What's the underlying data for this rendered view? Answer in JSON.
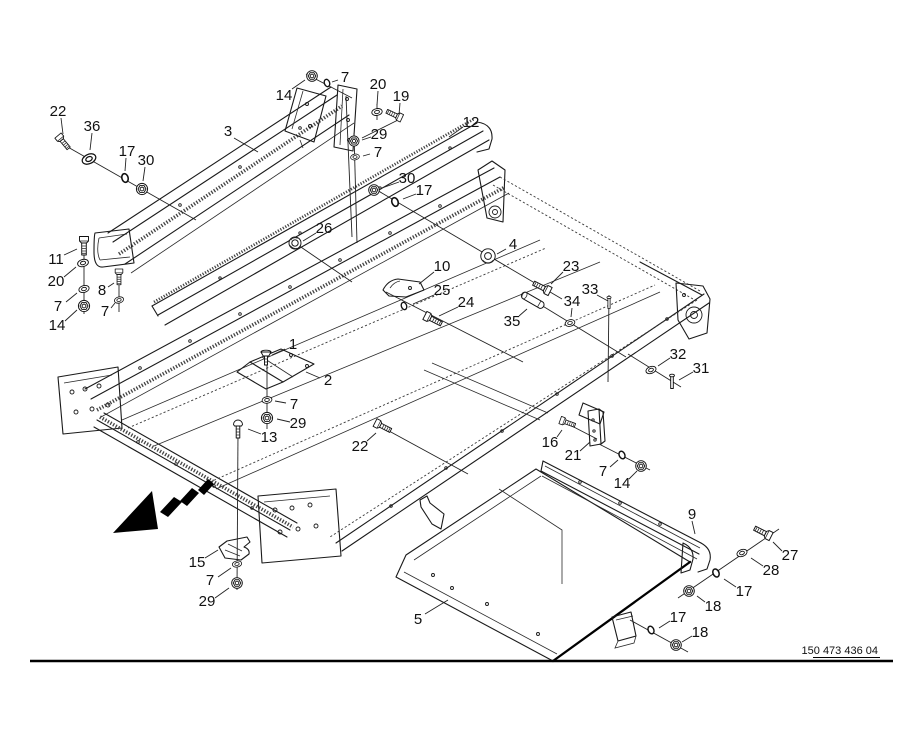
{
  "drawing": {
    "number": "150 473 436 04",
    "background": "#ffffff",
    "line_color": "#1a1a1a"
  },
  "arrow": {
    "meaning": "direction-of-travel",
    "color": "#000000"
  },
  "callouts": [
    {
      "t": "22",
      "x": 58,
      "y": 111,
      "l": [
        61,
        118,
        63,
        134
      ]
    },
    {
      "t": "36",
      "x": 92,
      "y": 126,
      "l": [
        92,
        133,
        90,
        150
      ]
    },
    {
      "t": "17",
      "x": 127,
      "y": 151,
      "l": [
        126,
        158,
        125,
        171
      ]
    },
    {
      "t": "30",
      "x": 146,
      "y": 160,
      "l": [
        145,
        167,
        143,
        181
      ]
    },
    {
      "t": "3",
      "x": 228,
      "y": 131,
      "l": [
        234,
        138,
        258,
        152
      ]
    },
    {
      "t": "14",
      "x": 284,
      "y": 95,
      "l": [
        292,
        89,
        305,
        80
      ]
    },
    {
      "t": "7",
      "x": 345,
      "y": 77,
      "l": [
        338,
        80,
        332,
        82
      ]
    },
    {
      "t": "20",
      "x": 378,
      "y": 84,
      "l": [
        378,
        91,
        377,
        105
      ]
    },
    {
      "t": "19",
      "x": 401,
      "y": 96,
      "l": [
        400,
        103,
        399,
        115
      ]
    },
    {
      "t": "29",
      "x": 379,
      "y": 134,
      "l": [
        371,
        137,
        362,
        140
      ]
    },
    {
      "t": "7",
      "x": 378,
      "y": 152,
      "l": [
        370,
        154,
        363,
        156
      ]
    },
    {
      "t": "12",
      "x": 471,
      "y": 122,
      "l": [
        463,
        127,
        449,
        137
      ]
    },
    {
      "t": "30",
      "x": 407,
      "y": 178,
      "l": [
        399,
        182,
        382,
        188
      ]
    },
    {
      "t": "17",
      "x": 424,
      "y": 190,
      "l": [
        416,
        194,
        403,
        199
      ]
    },
    {
      "t": "26",
      "x": 324,
      "y": 228,
      "l": [
        316,
        233,
        303,
        241
      ]
    },
    {
      "t": "4",
      "x": 513,
      "y": 244,
      "l": [
        506,
        249,
        497,
        254
      ]
    },
    {
      "t": "10",
      "x": 442,
      "y": 266,
      "l": [
        434,
        272,
        419,
        284
      ]
    },
    {
      "t": "23",
      "x": 571,
      "y": 266,
      "l": [
        563,
        272,
        551,
        284
      ]
    },
    {
      "t": "25",
      "x": 442,
      "y": 290,
      "l": [
        434,
        295,
        413,
        304
      ]
    },
    {
      "t": "24",
      "x": 466,
      "y": 302,
      "l": [
        458,
        307,
        439,
        316
      ]
    },
    {
      "t": "33",
      "x": 590,
      "y": 289,
      "l": [
        597,
        295,
        608,
        301
      ]
    },
    {
      "t": "34",
      "x": 572,
      "y": 301,
      "l": [
        572,
        308,
        571,
        317
      ]
    },
    {
      "t": "35",
      "x": 512,
      "y": 321,
      "l": [
        519,
        316,
        527,
        309
      ]
    },
    {
      "t": "32",
      "x": 678,
      "y": 354,
      "l": [
        670,
        358,
        658,
        366
      ]
    },
    {
      "t": "31",
      "x": 701,
      "y": 368,
      "l": [
        693,
        372,
        679,
        380
      ]
    },
    {
      "t": "1",
      "x": 293,
      "y": 344,
      "l": [
        285,
        349,
        272,
        355
      ]
    },
    {
      "t": "2",
      "x": 328,
      "y": 380,
      "l": [
        320,
        378,
        306,
        372
      ]
    },
    {
      "t": "7",
      "x": 294,
      "y": 404,
      "l": [
        286,
        403,
        275,
        401
      ]
    },
    {
      "t": "29",
      "x": 298,
      "y": 423,
      "l": [
        290,
        422,
        277,
        419
      ]
    },
    {
      "t": "13",
      "x": 269,
      "y": 437,
      "l": [
        261,
        434,
        248,
        429
      ]
    },
    {
      "t": "22",
      "x": 360,
      "y": 446,
      "l": [
        367,
        441,
        376,
        433
      ]
    },
    {
      "t": "11",
      "x": 56,
      "y": 259,
      "l": [
        64,
        255,
        77,
        249
      ]
    },
    {
      "t": "20",
      "x": 56,
      "y": 281,
      "l": [
        64,
        277,
        76,
        267
      ]
    },
    {
      "t": "7",
      "x": 58,
      "y": 306,
      "l": [
        66,
        302,
        77,
        293
      ]
    },
    {
      "t": "14",
      "x": 57,
      "y": 325,
      "l": [
        65,
        321,
        77,
        310
      ]
    },
    {
      "t": "8",
      "x": 102,
      "y": 290,
      "l": [
        108,
        287,
        114,
        283
      ]
    },
    {
      "t": "7",
      "x": 105,
      "y": 311,
      "l": [
        111,
        308,
        115,
        303
      ]
    },
    {
      "t": "15",
      "x": 197,
      "y": 562,
      "l": [
        205,
        558,
        218,
        550
      ]
    },
    {
      "t": "7",
      "x": 210,
      "y": 580,
      "l": [
        218,
        577,
        231,
        568
      ]
    },
    {
      "t": "29",
      "x": 207,
      "y": 601,
      "l": [
        215,
        598,
        229,
        588
      ]
    },
    {
      "t": "5",
      "x": 418,
      "y": 619,
      "l": [
        425,
        614,
        448,
        600
      ]
    },
    {
      "t": "16",
      "x": 550,
      "y": 442,
      "l": [
        557,
        437,
        562,
        430
      ]
    },
    {
      "t": "21",
      "x": 573,
      "y": 455,
      "l": [
        580,
        451,
        590,
        442
      ]
    },
    {
      "t": "7",
      "x": 603,
      "y": 471,
      "l": [
        610,
        467,
        618,
        460
      ]
    },
    {
      "t": "14",
      "x": 622,
      "y": 483,
      "l": [
        629,
        479,
        637,
        471
      ]
    },
    {
      "t": "9",
      "x": 692,
      "y": 514,
      "l": [
        692,
        521,
        695,
        534
      ]
    },
    {
      "t": "27",
      "x": 790,
      "y": 555,
      "l": [
        782,
        551,
        773,
        542
      ]
    },
    {
      "t": "28",
      "x": 771,
      "y": 570,
      "l": [
        763,
        566,
        751,
        558
      ]
    },
    {
      "t": "17",
      "x": 744,
      "y": 591,
      "l": [
        736,
        587,
        724,
        579
      ]
    },
    {
      "t": "18",
      "x": 713,
      "y": 606,
      "l": [
        705,
        602,
        697,
        596
      ]
    },
    {
      "t": "17",
      "x": 678,
      "y": 617,
      "l": [
        670,
        621,
        659,
        628
      ]
    },
    {
      "t": "18",
      "x": 700,
      "y": 632,
      "l": [
        692,
        636,
        682,
        642
      ]
    }
  ],
  "hardware": [
    {
      "k": "bolt",
      "x": 60,
      "y": 138,
      "r": 50,
      "s": 0.9
    },
    {
      "k": "washer",
      "x": 89,
      "y": 159,
      "r": -25,
      "s": 1.3
    },
    {
      "k": "ring",
      "x": 125,
      "y": 178,
      "r": -15,
      "s": 1
    },
    {
      "k": "flange-nut",
      "x": 142,
      "y": 189,
      "r": 0,
      "s": 1
    },
    {
      "k": "flange-nut",
      "x": 312,
      "y": 76,
      "r": 0,
      "s": 0.95
    },
    {
      "k": "ring",
      "x": 327,
      "y": 83,
      "r": -20,
      "s": 0.85
    },
    {
      "k": "washer",
      "x": 377,
      "y": 112,
      "r": -10,
      "s": 0.95
    },
    {
      "k": "bolt",
      "x": 399,
      "y": 117,
      "r": 205,
      "s": 0.9
    },
    {
      "k": "flange-nut",
      "x": 354,
      "y": 141,
      "r": 0,
      "s": 0.9
    },
    {
      "k": "washer",
      "x": 355,
      "y": 157,
      "r": -10,
      "s": 0.8
    },
    {
      "k": "flange-nut",
      "x": 374,
      "y": 190,
      "r": 0,
      "s": 0.95
    },
    {
      "k": "ring",
      "x": 395,
      "y": 202,
      "r": -20,
      "s": 1
    },
    {
      "k": "flange-bolt",
      "x": 295,
      "y": 243,
      "r": 0,
      "s": 1
    },
    {
      "k": "bushing",
      "x": 488,
      "y": 256,
      "r": 0,
      "s": 1
    },
    {
      "k": "bolt",
      "x": 547,
      "y": 290,
      "r": 207,
      "s": 1
    },
    {
      "k": "ring",
      "x": 404,
      "y": 306,
      "r": -20,
      "s": 0.85
    },
    {
      "k": "bolt",
      "x": 428,
      "y": 317,
      "r": 27,
      "s": 1
    },
    {
      "k": "small-pin",
      "x": 609,
      "y": 303,
      "r": 0,
      "s": 0.85
    },
    {
      "k": "washer",
      "x": 570,
      "y": 323,
      "r": -15,
      "s": 0.9
    },
    {
      "k": "pin",
      "x": 534,
      "y": 301,
      "r": 30,
      "s": 1
    },
    {
      "k": "washer",
      "x": 651,
      "y": 370,
      "r": -20,
      "s": 0.95
    },
    {
      "k": "small-pin",
      "x": 672,
      "y": 382,
      "r": 0,
      "s": 1
    },
    {
      "k": "screw-flat",
      "x": 266,
      "y": 352,
      "r": 0,
      "s": 1
    },
    {
      "k": "washer",
      "x": 267,
      "y": 400,
      "r": -8,
      "s": 0.9
    },
    {
      "k": "flange-nut",
      "x": 267,
      "y": 418,
      "r": 0,
      "s": 1
    },
    {
      "k": "bolt-top",
      "x": 238,
      "y": 423,
      "r": 0,
      "s": 1
    },
    {
      "k": "bolt",
      "x": 378,
      "y": 424,
      "r": 27,
      "s": 0.95
    },
    {
      "k": "bolt",
      "x": 84,
      "y": 240,
      "r": 90,
      "s": 1
    },
    {
      "k": "washer",
      "x": 83,
      "y": 263,
      "r": -15,
      "s": 1
    },
    {
      "k": "washer",
      "x": 84,
      "y": 289,
      "r": -15,
      "s": 0.95
    },
    {
      "k": "flange-nut",
      "x": 84,
      "y": 306,
      "r": 0,
      "s": 1
    },
    {
      "k": "bolt",
      "x": 119,
      "y": 272,
      "r": 90,
      "s": 0.85
    },
    {
      "k": "washer",
      "x": 119,
      "y": 300,
      "r": -15,
      "s": 0.85
    },
    {
      "k": "washer",
      "x": 237,
      "y": 564,
      "r": -10,
      "s": 0.85
    },
    {
      "k": "flange-nut",
      "x": 237,
      "y": 583,
      "r": 0,
      "s": 0.95
    },
    {
      "k": "bolt",
      "x": 563,
      "y": 421,
      "r": 20,
      "s": 0.85
    },
    {
      "k": "ring",
      "x": 622,
      "y": 455,
      "r": -25,
      "s": 0.9
    },
    {
      "k": "flange-nut",
      "x": 641,
      "y": 466,
      "r": 0,
      "s": 0.95
    },
    {
      "k": "bolt",
      "x": 768,
      "y": 535,
      "r": 207,
      "s": 1
    },
    {
      "k": "washer",
      "x": 742,
      "y": 553,
      "r": -20,
      "s": 0.95
    },
    {
      "k": "ring",
      "x": 716,
      "y": 573,
      "r": -25,
      "s": 0.95
    },
    {
      "k": "flange-nut",
      "x": 689,
      "y": 591,
      "r": 0,
      "s": 0.95
    },
    {
      "k": "ring",
      "x": 651,
      "y": 630,
      "r": -25,
      "s": 0.9
    },
    {
      "k": "flange-nut",
      "x": 676,
      "y": 645,
      "r": 0,
      "s": 0.95
    }
  ],
  "assembly_lines": [
    [
      66,
      146,
      196,
      220
    ],
    [
      84,
      238,
      84,
      314
    ],
    [
      119,
      270,
      119,
      312
    ],
    [
      306,
      74,
      352,
      98
    ],
    [
      377,
      104,
      377,
      120
    ],
    [
      402,
      118,
      362,
      138
    ],
    [
      354,
      133,
      357,
      243
    ],
    [
      346,
      96,
      352,
      237
    ],
    [
      370,
      186,
      562,
      299
    ],
    [
      295,
      243,
      352,
      282
    ],
    [
      386,
      292,
      523,
      362
    ],
    [
      523,
      294,
      626,
      357
    ],
    [
      609,
      295,
      608,
      382
    ],
    [
      628,
      354,
      681,
      387
    ],
    [
      267,
      350,
      267,
      429
    ],
    [
      238,
      432,
      237,
      590
    ],
    [
      378,
      425,
      468,
      474
    ],
    [
      566,
      423,
      597,
      439
    ],
    [
      599,
      444,
      650,
      470
    ],
    [
      779,
      529,
      678,
      598
    ],
    [
      630,
      620,
      688,
      652
    ]
  ]
}
